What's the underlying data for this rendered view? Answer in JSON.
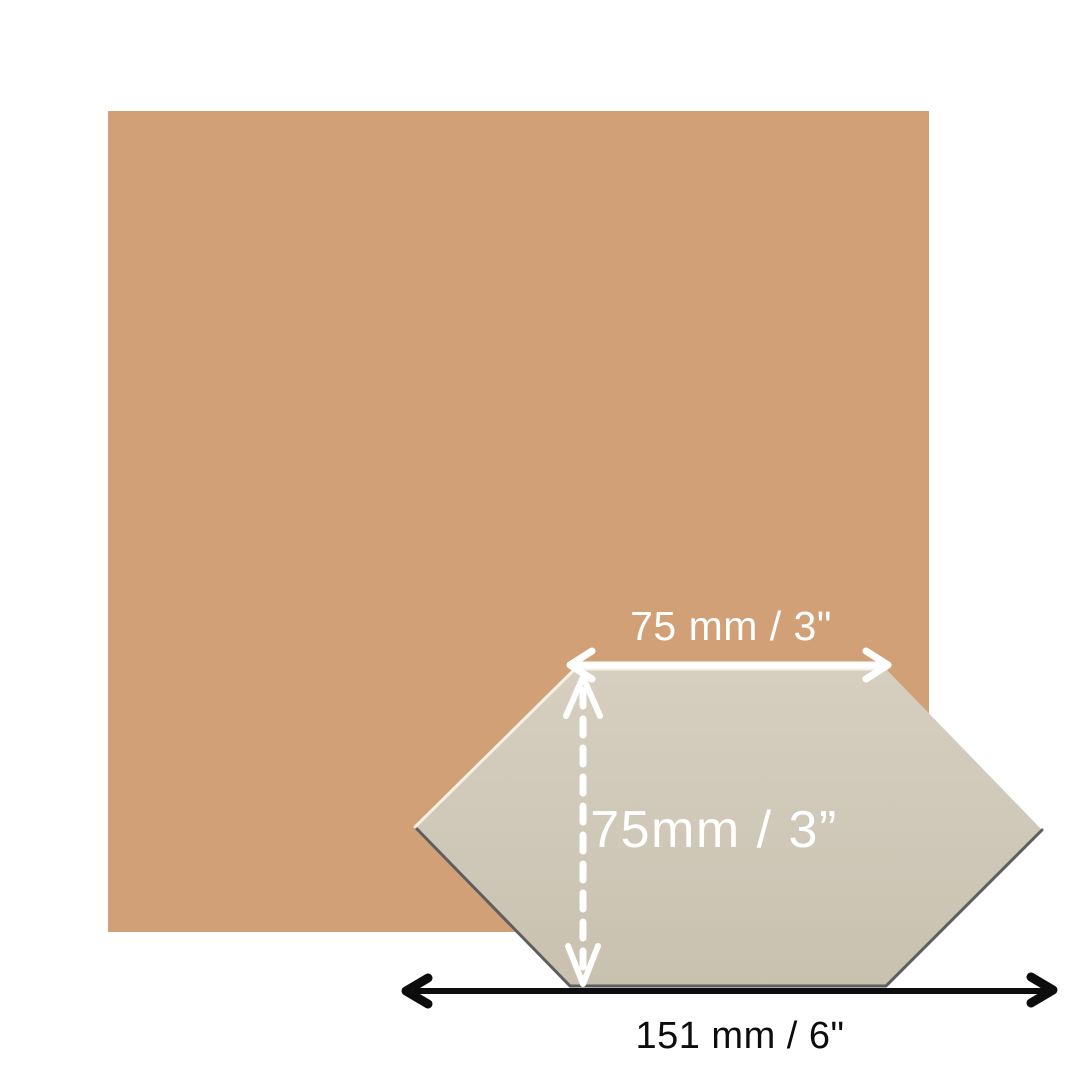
{
  "canvas": {
    "width": 1080,
    "height": 1080,
    "background": "#ffffff"
  },
  "swatch": {
    "fill": "#d2a077"
  },
  "tile": {
    "points": "415,827 575,669 886,669 1042,830 886,986 570,986",
    "fill_top": "#d6cfc0",
    "fill_bottom": "#c9c1b0",
    "shadow_color": "#5e5e60",
    "highlight_color": "#f4f0e6"
  },
  "dimensions": {
    "top_width": {
      "label": "75 mm / 3\"",
      "color": "#ffffff"
    },
    "height": {
      "label": "75mm / 3”",
      "color": "#ffffff"
    },
    "total_width": {
      "label": "151 mm / 6\"",
      "color": "#0d0d0d"
    }
  }
}
